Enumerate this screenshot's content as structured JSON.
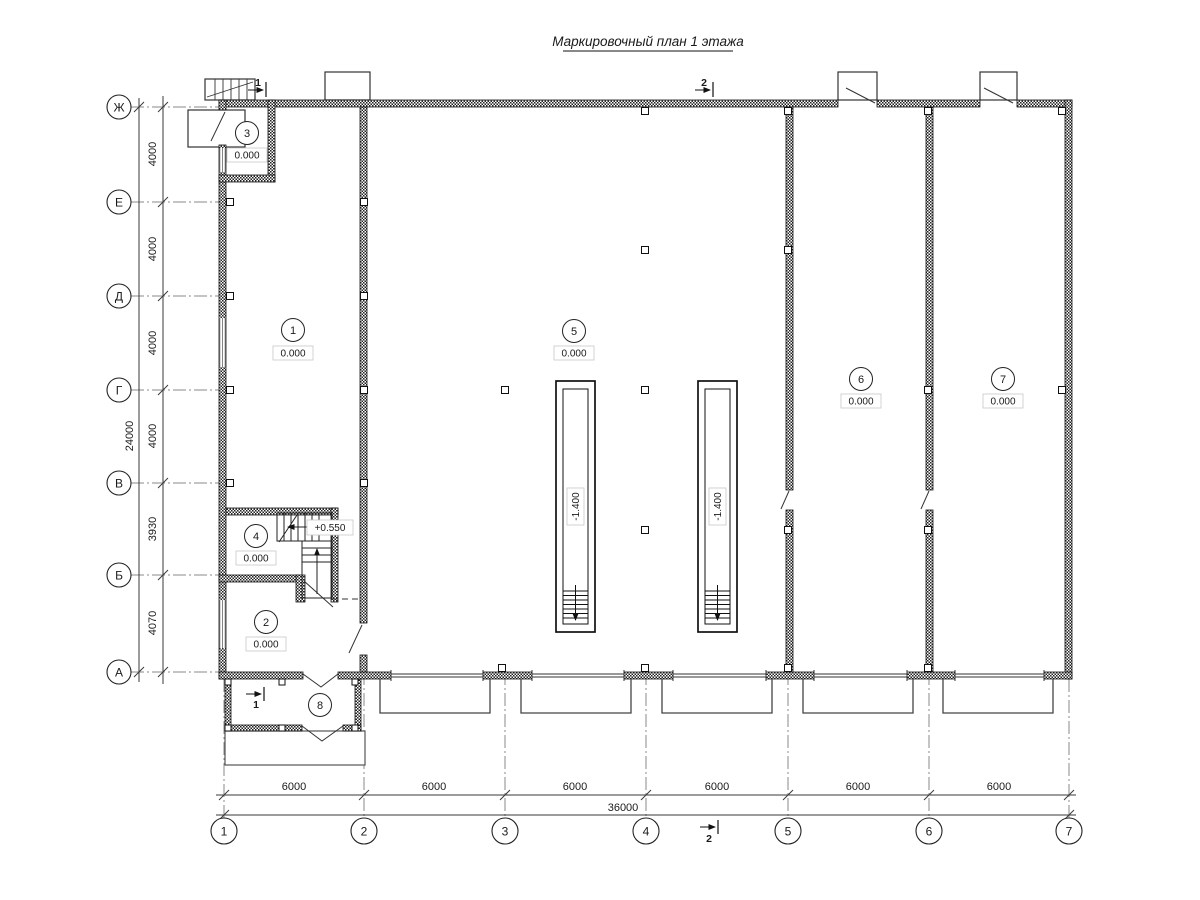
{
  "title": "Маркировочный план 1 этажа",
  "axes": {
    "rows": [
      {
        "label": "Ж"
      },
      {
        "label": "Е"
      },
      {
        "label": "Д"
      },
      {
        "label": "Г"
      },
      {
        "label": "В"
      },
      {
        "label": "Б"
      },
      {
        "label": "А"
      }
    ],
    "cols": [
      {
        "label": "1"
      },
      {
        "label": "2"
      },
      {
        "label": "3"
      },
      {
        "label": "4"
      },
      {
        "label": "5"
      },
      {
        "label": "6"
      },
      {
        "label": "7"
      }
    ]
  },
  "dimensions": {
    "left_segments": [
      "4000",
      "4000",
      "4000",
      "4000",
      "3930",
      "4070"
    ],
    "left_total": "24000",
    "bottom_segments": [
      "6000",
      "6000",
      "6000",
      "6000",
      "6000",
      "6000"
    ],
    "bottom_total": "36000"
  },
  "rooms": [
    {
      "number": "1",
      "elevation": "0.000"
    },
    {
      "number": "2",
      "elevation": "0.000"
    },
    {
      "number": "3",
      "elevation": "0.000"
    },
    {
      "number": "4",
      "elevation": "0.000"
    },
    {
      "number": "5",
      "elevation": "0.000"
    },
    {
      "number": "6",
      "elevation": "0.000"
    },
    {
      "number": "7",
      "elevation": "0.000"
    },
    {
      "number": "8"
    }
  ],
  "pits": [
    {
      "elevation": "-1.400"
    },
    {
      "elevation": "-1.400"
    }
  ],
  "stair": {
    "elevation": "+0.550"
  },
  "sections": {
    "top_left": {
      "number": "1"
    },
    "top_mid": {
      "number": "2"
    },
    "bottom_left": {
      "number": "1"
    },
    "bottom_mid": {
      "number": "2"
    }
  }
}
